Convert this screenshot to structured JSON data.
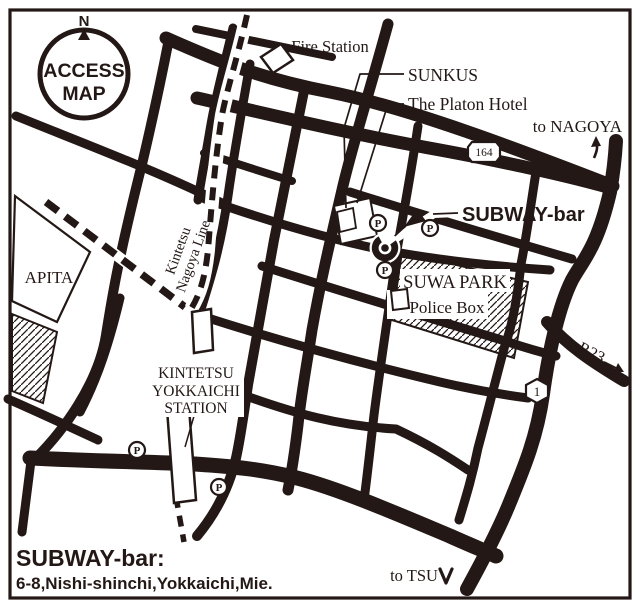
{
  "colors": {
    "ink": "#231815",
    "paper": "#ffffff"
  },
  "compass": {
    "north": "N",
    "line1": "ACCESS",
    "line2": "MAP"
  },
  "landmarks": {
    "fire_station": "Fire Station",
    "sunkus": "SUNKUS",
    "platon_hotel": "The Platon Hotel",
    "apita": "APITA",
    "suwa_park": "SUWA PARK",
    "police_box": "Police Box",
    "station_line1": "KINTETSU",
    "station_line2": "YOKKAICHI",
    "station_line3": "STATION",
    "railway_line1": "Kintetsu",
    "railway_line2": "Nagoya Line"
  },
  "venue": {
    "map_label": "SUBWAY-bar"
  },
  "directions": {
    "nagoya": "to NAGOYA",
    "tsu": "to TSU",
    "r23": "to R23"
  },
  "route_badges": {
    "route_164": "164",
    "route_1": "1"
  },
  "parking": {
    "symbol": "P"
  },
  "footer": {
    "title": "SUBWAY-bar:",
    "address": "6-8,Nishi-shinchi,Yokkaichi,Mie."
  }
}
